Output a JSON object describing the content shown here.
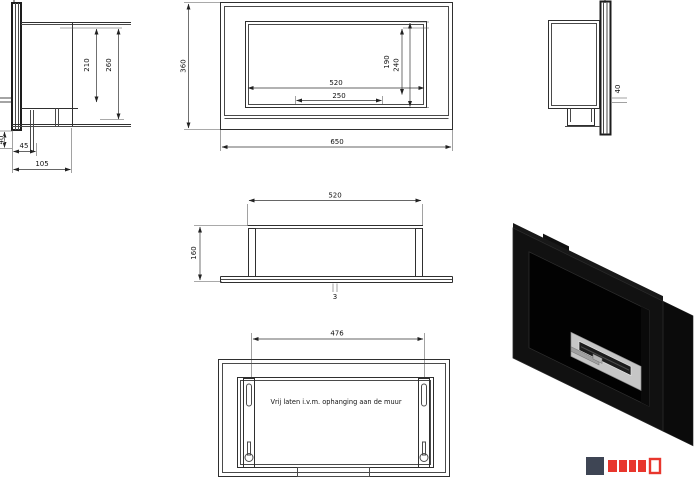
{
  "views": {
    "side_left": {
      "height_inner": "210",
      "height_outer": "260",
      "wall_offset": "40",
      "foot_width": "45",
      "base_width": "105"
    },
    "front": {
      "opening_width": "520",
      "slot_width": "250",
      "opening_height": "240",
      "inner_height": "190",
      "overall_height": "360",
      "overall_width": "650"
    },
    "side_right": {
      "gap": "40"
    },
    "top": {
      "width": "520",
      "depth": "160",
      "plate_thickness": "3"
    },
    "rear": {
      "bracket_spacing": "476",
      "note": "Vrij laten i.v.m. ophanging aan de muur"
    }
  },
  "logo": {
    "mark_color": "#3e4554",
    "wordmark_color": "#e8362d"
  }
}
